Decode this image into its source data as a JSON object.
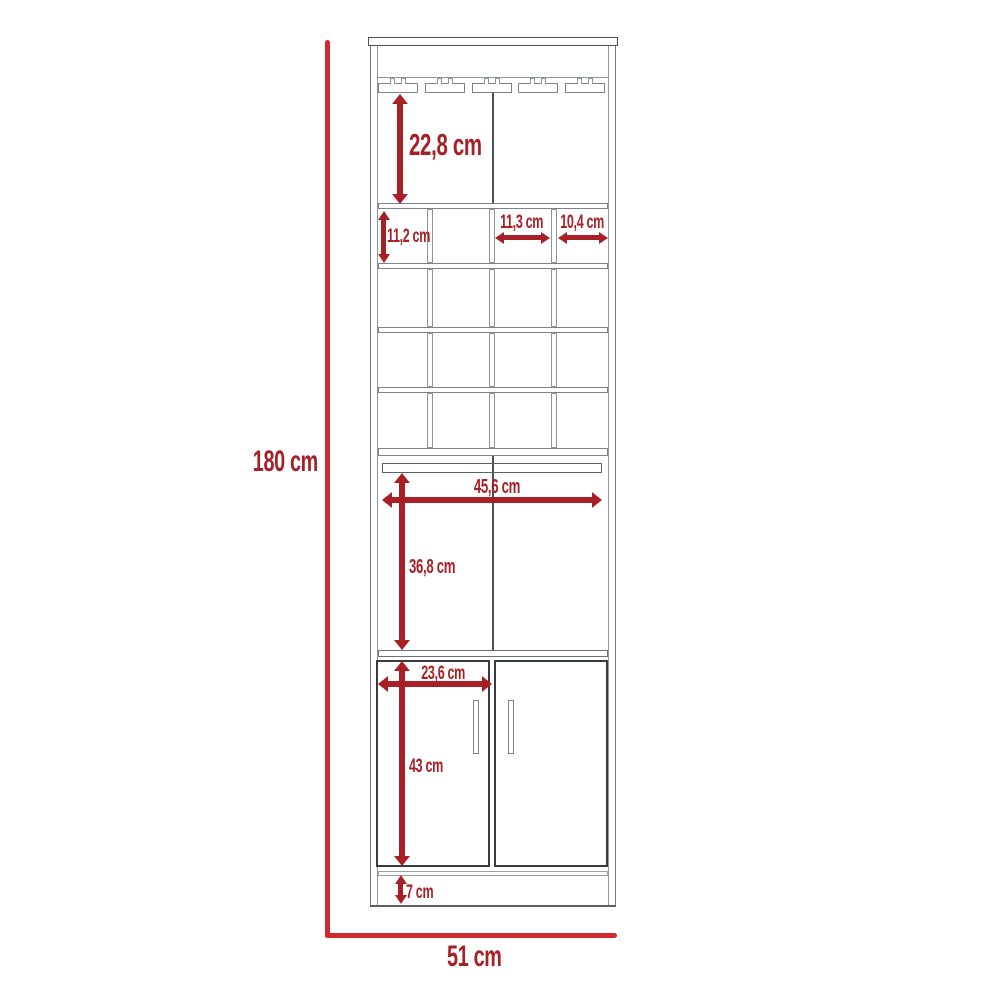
{
  "diagram": {
    "title": "bar-cabinet-front-view-dimension-diagram",
    "colors": {
      "outer_dimension_line": "#d2282e",
      "inner_dimension": "#a81f25",
      "outline_dark": "#4b5054",
      "outline_light": "#8f969b",
      "background": "#ffffff"
    },
    "structure": {
      "stemware_rails": 5,
      "wine_cubby_rows": 4,
      "wine_cubby_columns": 4,
      "doors": 2
    },
    "labels": {
      "overall_height": "180 cm",
      "overall_width": "51 cm",
      "glass_section_height": "22,8 cm",
      "cubby_height": "11,2 cm",
      "cubby_inner_width": "11,3 cm",
      "cubby_outer_width": "10,4 cm",
      "middle_shelf_width": "45,6 cm",
      "middle_section_height": "36,8 cm",
      "door_width": "23,6 cm",
      "door_height": "43 cm",
      "base_height": "7 cm"
    }
  }
}
